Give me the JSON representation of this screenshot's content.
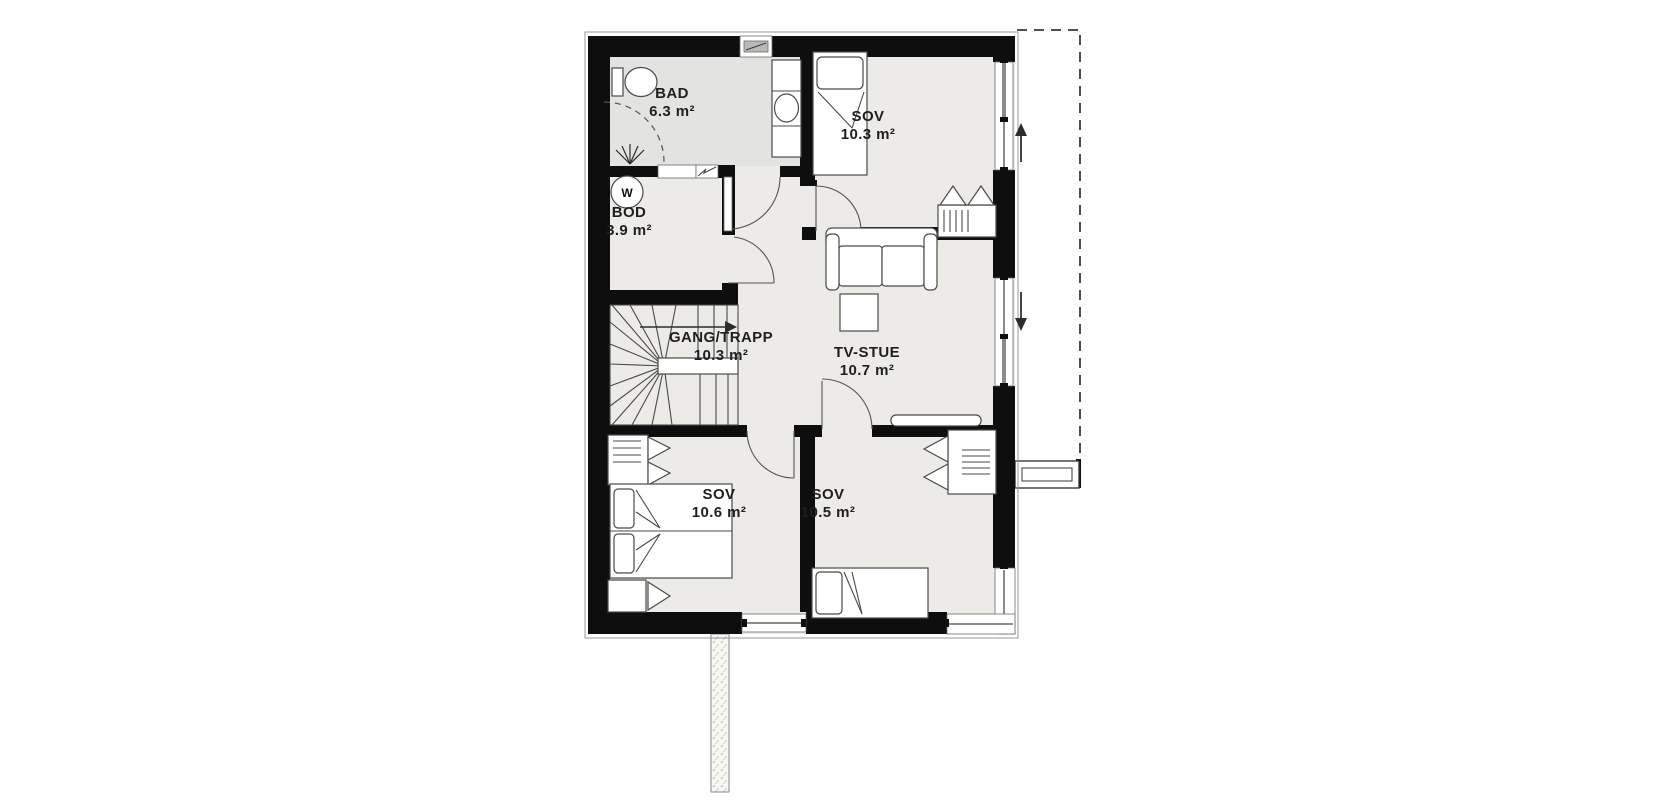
{
  "plan": {
    "rooms": [
      {
        "name": "BAD",
        "area": "6.3 m²"
      },
      {
        "name": "SOV",
        "area": "10.3 m²"
      },
      {
        "name": "BOD",
        "area": "3.9 m²"
      },
      {
        "name": "GANG/TRAPP",
        "area": "10.3 m²"
      },
      {
        "name": "TV-STUE",
        "area": "10.7 m²"
      },
      {
        "name": "SOV",
        "area": "10.6 m²"
      },
      {
        "name": "SOV",
        "area": "10.5 m²"
      }
    ],
    "symbols": {
      "hot_water_label": "W"
    },
    "colors": {
      "wall": "#0e0e0e",
      "floor": "#ecebe7",
      "bath_floor": "#e3e3e1",
      "line": "#4a4a48",
      "background": "#ffffff"
    }
  }
}
